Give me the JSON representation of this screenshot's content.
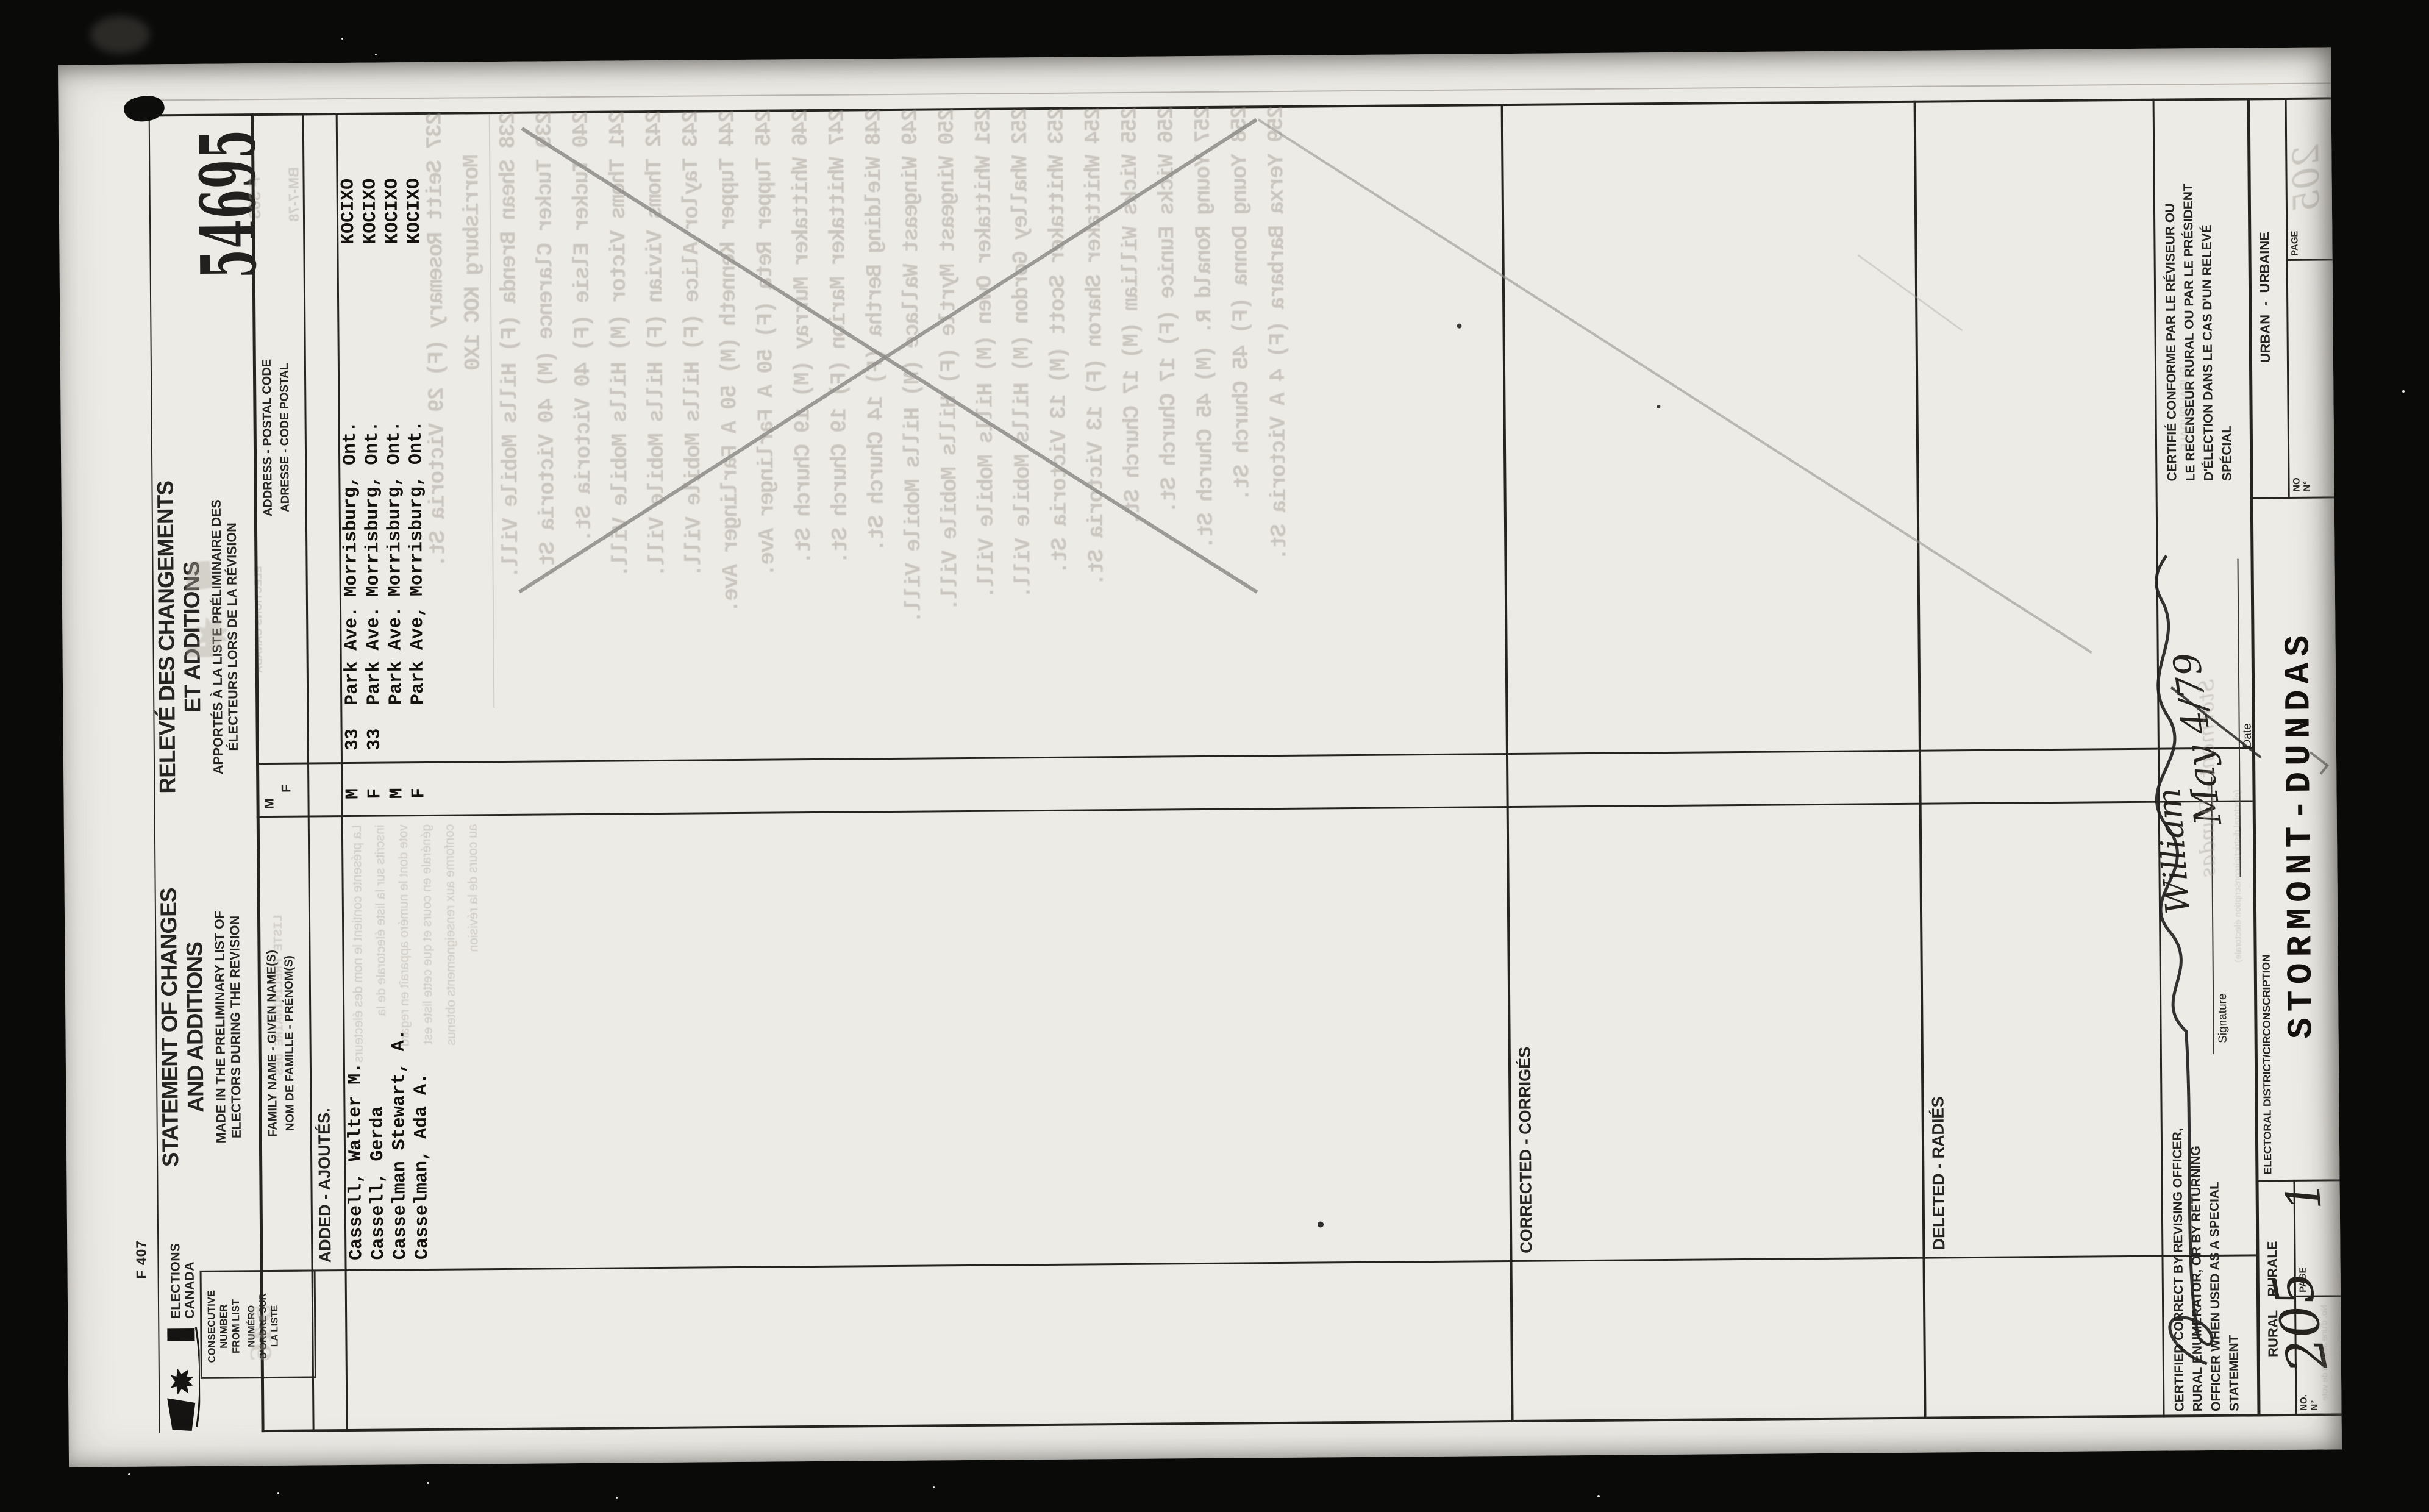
{
  "form_number": "F 407",
  "stamp_number": "54695",
  "agency": {
    "line1": "ELECTIONS",
    "line2": "CANADA"
  },
  "title": {
    "en1": "STATEMENT OF CHANGES",
    "en2": "AND ADDITIONS",
    "en3": "MADE IN THE PRELIMINARY LIST OF",
    "en4": "ELECTORS DURING THE REVISION",
    "fr1": "RELEVÉ DES CHANGEMENTS",
    "fr2": "ET ADDITIONS",
    "fr3": "APPORTÉS À LA LISTE PRÉLIMINAIRE DES",
    "fr4": "ÉLECTEURS LORS DE LA RÉVISION"
  },
  "headers": {
    "consec": [
      "CONSECUTIVE",
      "NUMBER",
      "FROM LIST",
      "NUMÉRO",
      "D'ORDRE SUR",
      "LA LISTE"
    ],
    "family1": "FAMILY NAME - GIVEN NAME(S)",
    "family2": "NOM DE FAMILLE - PRÉNOM(S)",
    "sex_m": "M",
    "sex_f": "F",
    "address1": "ADDRESS - POSTAL CODE",
    "address2": "ADRESSE - CODE POSTAL"
  },
  "sections": {
    "added": "ADDED - AJOUTÉS.",
    "corrected": "CORRECTED - CORRIGÉS",
    "deleted": "DELETED - RADIÉS"
  },
  "rows": [
    {
      "name": "Cassell, Walter M.",
      "sex": "M",
      "number": "33",
      "street": "Park Ave.",
      "city": "Morrisburg, Ont.",
      "postal": "KOCIXO"
    },
    {
      "name": "Cassell, Gerda",
      "sex": "F",
      "number": "33",
      "street": "Park Ave.",
      "city": "Morrisburg, Ont.",
      "postal": "KOCIXO"
    },
    {
      "name": "Casselman Stewart, A.",
      "sex": "M",
      "number": "",
      "street": "Park Ave.",
      "city": "Morrisburg, Ont.",
      "postal": "KOCIXO"
    },
    {
      "name": "Casselman, Ada A.",
      "sex": "F",
      "number": "",
      "street": "Park Ave,",
      "city": "Morrisburg, Ont.",
      "postal": "KOCIXO"
    }
  ],
  "certification": {
    "en": [
      "CERTIFIED CORRECT BY REVISING OFFICER,",
      "RURAL ENUMERATOR, OR BY RETURNING",
      "OFFICER WHEN USED AS A SPECIAL",
      "STATEMENT"
    ],
    "fr": [
      "CERTIFIÉ CONFORME PAR LE RÉVISEUR OU",
      "LE RECENSEUR RURAL OU PAR LE PRÉSIDENT",
      "D'ÉLECTION DANS LE CAS D'UN RELEVÉ",
      "SPÉCIAL"
    ],
    "signature_label": "Signature",
    "date_label": "Date",
    "signature_value": "William",
    "date_value": "May 4/79"
  },
  "district": {
    "label": "ELECTORAL DISTRICT/CIRCONSCRIPTION",
    "value": "STORMONT-DUNDAS"
  },
  "rural": {
    "label": "RURAL RURALE",
    "no_label": "NO.",
    "no_label2": "N°",
    "page_label": "PAGE",
    "no_value": "205",
    "page_value": "1"
  },
  "urban": {
    "label": "URBAN - URBAINE",
    "no_label": "NO",
    "no_label2": "N°",
    "page_label": "PAGE"
  },
  "ghosts": {
    "codes": [
      "F 303",
      "BM-7-78"
    ],
    "stamp": "546",
    "family_header": "LISTE PRÉLIMINAIRE DES",
    "agency": "ELECTIONS CANADA",
    "urban_page": "205",
    "district_hand": "Stormont - Dundas",
    "district_small": "(electoral district/circonscription électorale)",
    "rural_small": "RURAL RURALE",
    "polling": "No. d'une section de vote",
    "instructions": [
      "La présente contient le nom des électeurs",
      "inscrits sur la liste électorale de la",
      "vote dont le numéro apparaît en regard",
      "générale en cours et que cette liste est",
      "conforme aux renseignements obtenus",
      "au cours de la révision"
    ],
    "list": [
      "237 Seitt Rosemary (F) 29 Victoria St.",
      "Morrisburg KOC 1X0",
      "238 Shean Brenda (F) Hills Mobile Vill.",
      "239 Tucker Clarence (M) 40 Victoria St.",
      "240 Tucker Elsie (F) 40 Victoria St.",
      "241 Thoms Victor (M) Hills Mobile Vill.",
      "242 Thoms Vivian (F) Hills Mobile Vill.",
      "243 Taylor Alice (F) Hills Mobile Vill.",
      "244 Tupper Kenneth (M) 50 A Farlinger Ave.",
      "245 Tupper Reta (F) 50 A Farlinger Ave.",
      "246 Whittaker Murray (M) 19 Church St.",
      "247 Whittaker Marion (F) 19 Church St.",
      "248 Wielding Bertha (F) 14 Church St.",
      "249 Wingeast Wallace (M) Hills Mobile Vill.",
      "250 Wingeast Myrtle (F) Hills Mobile Vill.",
      "251 Whittaker Owen (M) Hills Mobile Vill.",
      "252 Whalley Gordon (M) Hills Mobile Vill.",
      "253 Whittaker Scott (M) 13 Victoria St.",
      "254 Whittaker Sharon (F) 13 Victoria St.",
      "255 Wicks William (M) 17 Church St.",
      "256 Wicks Eunice (F) 17 Church St.",
      "257 Young Ronald R. (M) 45 Church St.",
      "258 Young Donna (F) 45 Church St.",
      "259 Yerxa Barbara (F) 4 A Victoria St."
    ]
  },
  "colors": {
    "background": "#0a0a09",
    "paper": "#edebe6",
    "typed_ink": "#14110f",
    "printed_ink": "#262422",
    "pencil": "#8f8d89",
    "ghost": "#a19b91"
  }
}
